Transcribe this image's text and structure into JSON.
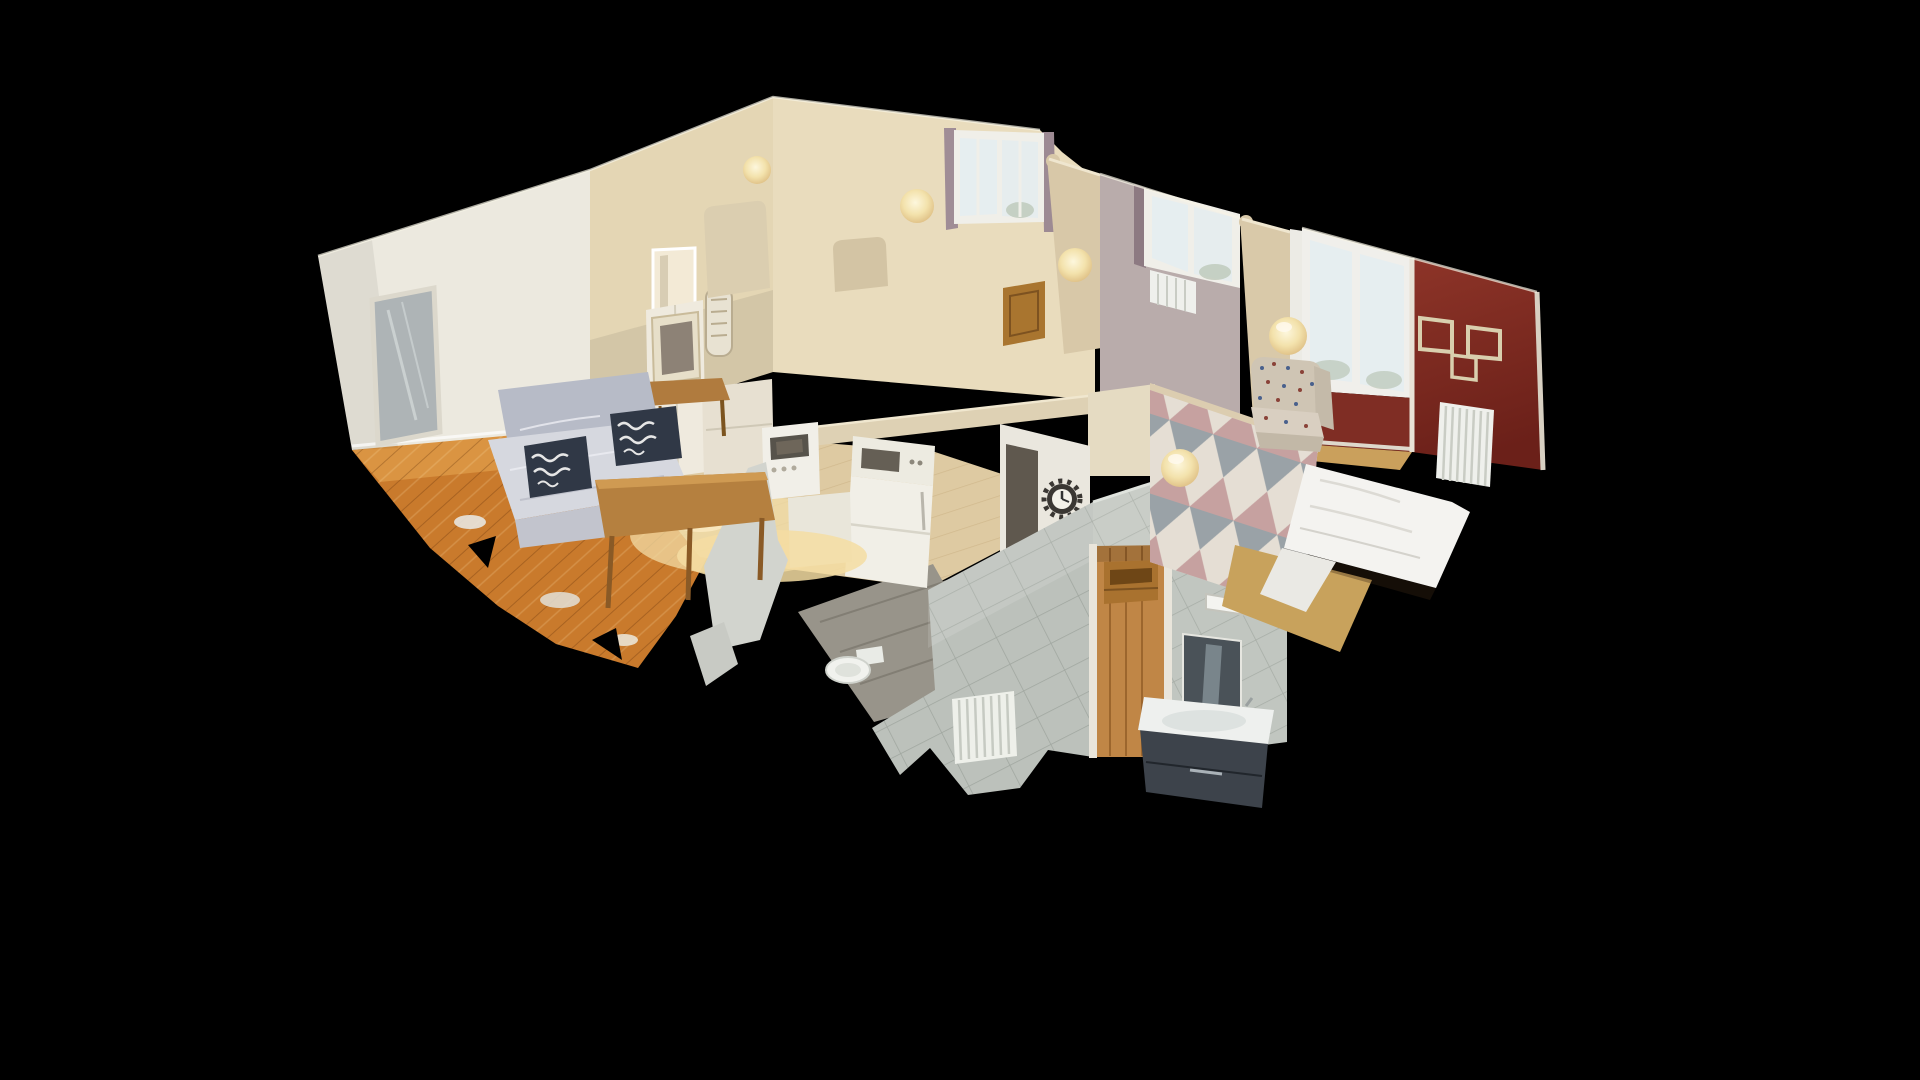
{
  "viewer": {
    "type": "3D virtual tour viewer",
    "view_mode": "dollhouse cutaway",
    "background": "#000000",
    "interaction": "drag-to-orbit model"
  },
  "scene": {
    "title": "Apartment dollhouse scan",
    "description": "Top-down angled cutaway of a small apartment photogrammetry scan floating on a black void: living room at left, kitchen and hallway in the middle, two bedrooms along the top, red-walled bedroom at right, tiled bathroom protruding toward the viewer at bottom center.",
    "style": "scanned mesh with ragged cut wall edges and glowing wall lamps"
  },
  "palette": {
    "background": "#000000",
    "wall_white": "#ece9df",
    "wall_cream": "#e4d6b4",
    "far_wall": "#e9dcbd",
    "wall_mauve": "#b9acab",
    "wall_red": "#7f2d24",
    "partition": "#d8c8a8",
    "band": "#ded1b4",
    "tile": "#bcc1bb",
    "tile_light": "#c9cdc7",
    "hall_floor": "#decaa2",
    "parquet": "#c97a2c",
    "screed": "#98948a",
    "door_wood": "#c08646",
    "sky": "#e6eef0",
    "duvet": "#f4f3f0",
    "sofa_cover": "#d6d8df",
    "sofa_base": "#b7bbc7",
    "pillow": "#303846",
    "lamp": "#f3e2ac",
    "vanity": "#3d434b",
    "sink": "#eef0ee",
    "radiator": "#eff0ec",
    "clock_face": "#f3f1e9",
    "wood_furniture": "#b07b3e",
    "mirror_glass": "#aeb4b6",
    "bath_mirror": "#4a5258",
    "frame_outline": "#d9cfae",
    "armchair": "#cfc5b4",
    "platform": "#c8a25c",
    "curtain_mauve": "#a08d96",
    "fragment": "#d2d4ce"
  },
  "rooms": [
    {
      "id": "living-room",
      "label": "Living room",
      "objects": [
        "white walls",
        "standing mirror",
        "grey sofa with slipcover",
        "two black-and-white patterned cushions",
        "wooden coffee bench",
        "wooden dining table",
        "orange herringbone parquet floor"
      ]
    },
    {
      "id": "kitchen-hall",
      "label": "Kitchen / hallway",
      "objects": [
        "white tall cabinet",
        "glass-front cupboard",
        "oven",
        "microwave on fridge",
        "white fridge",
        "warm under-cabinet light",
        "pale wood hall floor",
        "dark gear-style wall clock"
      ]
    },
    {
      "id": "middle-bedroom",
      "label": "Middle bedroom",
      "objects": [
        "tall window with mauve curtains",
        "globe wall lamp",
        "wooden door"
      ]
    },
    {
      "id": "second-bedroom",
      "label": "Second bedroom",
      "objects": [
        "window with mauve curtain",
        "small white radiator",
        "globe wall lamp"
      ]
    },
    {
      "id": "right-bedroom",
      "label": "Right bedroom",
      "objects": [
        "burgundy accent wall",
        "three empty square picture frames",
        "large bright window",
        "white column radiator",
        "bed with white duvet",
        "floral upholstered armchair",
        "triangle-pattern wallpaper wall",
        "globe wall lamps"
      ]
    },
    {
      "id": "bathroom",
      "label": "Bathroom",
      "objects": [
        "grey tiled cut walls",
        "doorway showing wooden floor",
        "wooden shelf unit",
        "mirror with light bar",
        "dark vanity with white sink",
        "toilet",
        "small radiator",
        "grey screed floor",
        "torn pale mesh fragments"
      ]
    }
  ],
  "lighting": {
    "wall_lamp_count": 5,
    "lamp_color": "#f3e2ac"
  }
}
